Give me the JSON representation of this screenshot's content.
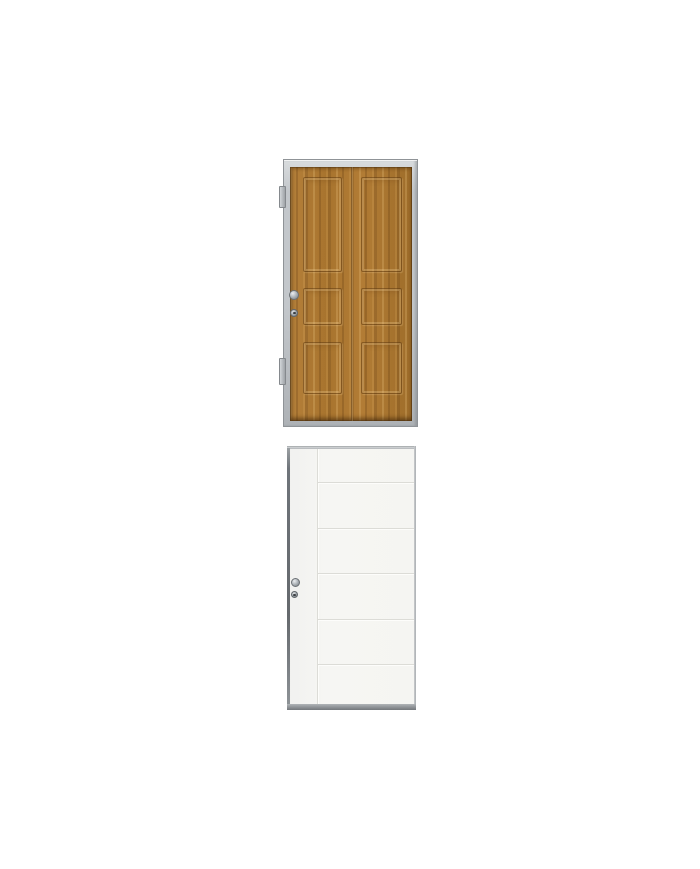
{
  "page": {
    "background": "#ffffff"
  },
  "colors": {
    "wood_base": "#a9752e",
    "wood_light": "#c79a55",
    "wood_dark": "#7d4f1c",
    "steel_frame": "#c3c7cb",
    "steel_frame_dark": "#8f9397",
    "white_face": "#f6f6f3",
    "white_groove": "#dcdcd7",
    "white_frame": "#abafb2",
    "door_edge_dark": "#65696d",
    "sill_gray": "#85898d",
    "hardware_metal": "#a7adb2"
  },
  "products": [
    {
      "name": "golden-oak-six-panel-door",
      "panel_columns": 2,
      "panel_rows": 3,
      "hinge_count": 2,
      "hardware": [
        "round-knob",
        "key-cylinder"
      ]
    },
    {
      "name": "white-grooved-flush-door",
      "horizontal_grooves": 5,
      "vertical_grooves": 1,
      "hardware": [
        "round-knob",
        "key-cylinder"
      ]
    }
  ]
}
